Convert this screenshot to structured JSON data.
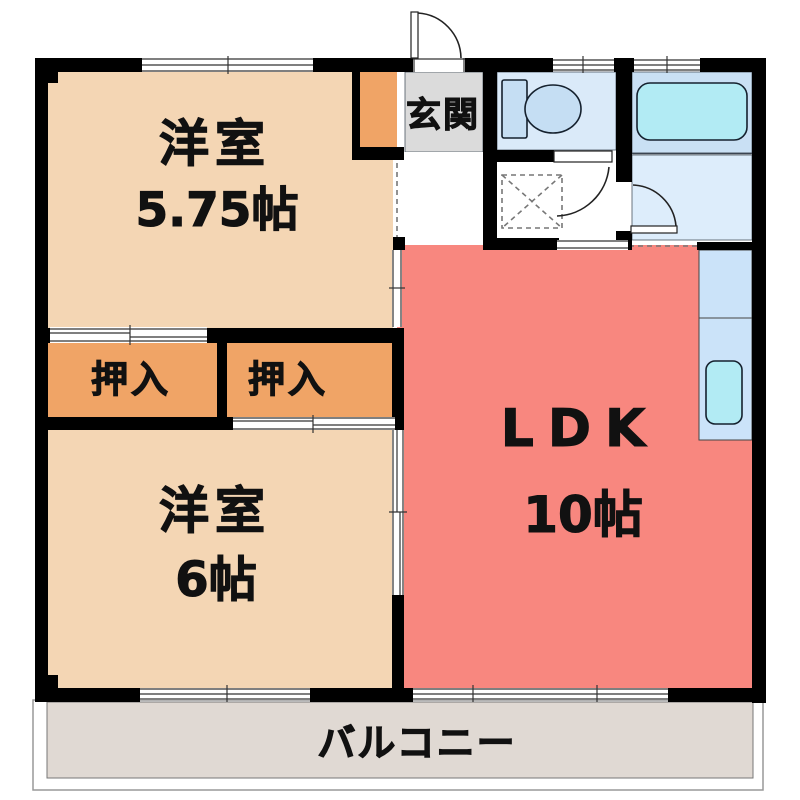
{
  "type": "apartment-floor-plan",
  "rooms": {
    "bedroom1": {
      "name": "洋室",
      "size": "5.75帖"
    },
    "bedroom2": {
      "name": "洋室",
      "size": "6帖"
    },
    "ldk": {
      "name": "LDK",
      "size": "10帖"
    },
    "entrance": {
      "label": "玄関"
    },
    "closet_left": {
      "label": "押入"
    },
    "closet_right": {
      "label": "押入"
    },
    "balcony": {
      "label": "バルコニー"
    }
  },
  "colors": {
    "bedroom": "#F4D6B4",
    "closet": "#F0A466",
    "ldk": "#F8877F",
    "entrance_hall": "#DBDBDB",
    "hallway": "#FFFFFF",
    "toilet_room": "#DAEAF9",
    "bath_room": "#C9E0F4",
    "washbasin_room": "#DDEDFB",
    "washroom": "#FFFFFF",
    "kitchen_counter": "#CBE3F9",
    "fixture_cyan": "#B2EBF4",
    "toilet_fixture": "#C5DEF3",
    "balcony": "#E0D9D3",
    "wall": "#000000"
  }
}
